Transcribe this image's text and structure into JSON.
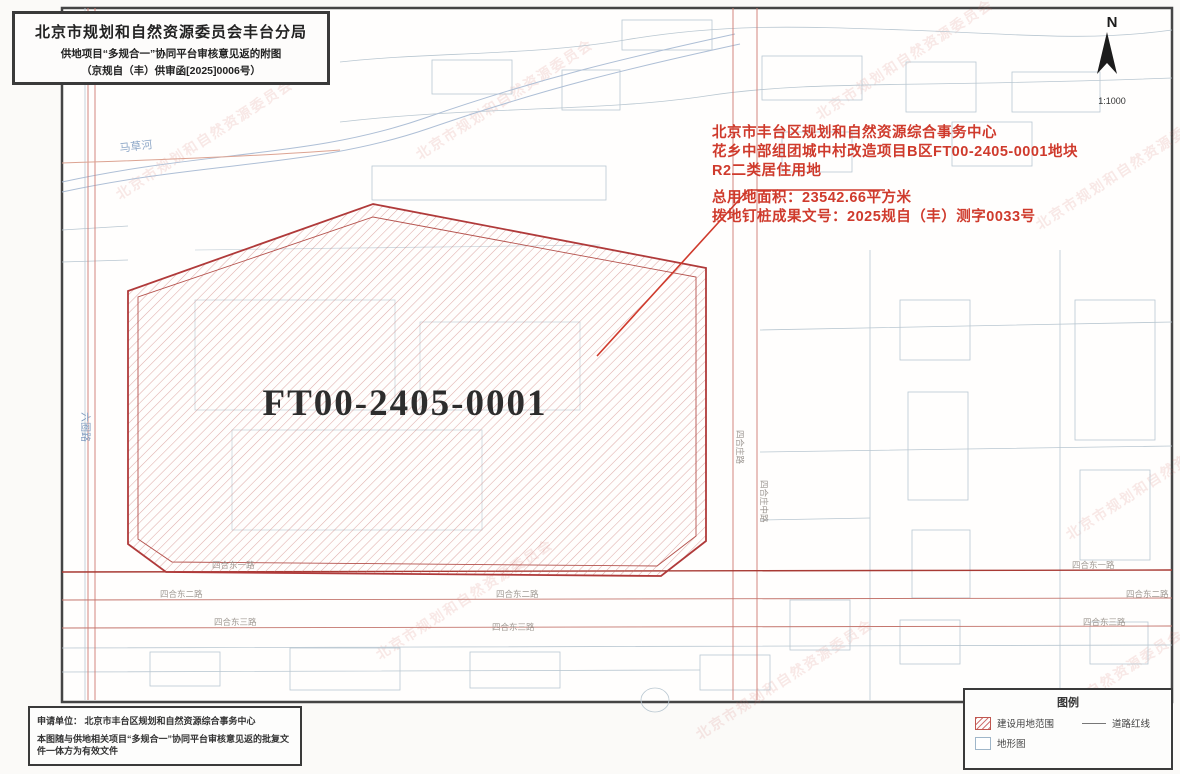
{
  "title_block": {
    "line1": "北京市规划和自然资源委员会丰台分局",
    "line2": "供地项目“多规合一”协同平台审核意见返的附图",
    "line3": "（京规自（丰）供审函[2025]0006号）"
  },
  "north": {
    "label": "N",
    "scale": "1:1000"
  },
  "annotation": {
    "line1": "北京市丰台区规划和自然资源综合事务中心",
    "line2": "花乡中部组团城中村改造项目B区FT00-2405-0001地块",
    "line3": "R2二类居住用地",
    "line4": "总用地面积：23542.66平方米",
    "line5": "拨地钉桩成果文号：2025规自（丰）测字0033号"
  },
  "parcel": {
    "label": "FT00-2405-0001"
  },
  "legend": {
    "title": "图例",
    "item_build": "建设用地范围",
    "item_road": "道路红线",
    "item_base": "地形图"
  },
  "info_block": {
    "line1": "申请单位：  北京市丰台区规划和自然资源综合事务中心",
    "line2": "本图随与供地相关项目“多规合一”协同平台审核意见返的批复文件一体方为有效文件"
  },
  "map_labels": {
    "river": "马草河",
    "road_left": "六圈路",
    "road_v1": "四合庄路",
    "road_v2": "四合庄中路",
    "road_h1": "四合东一路",
    "road_h2": "四合东二路",
    "road_h3": "四合东三路"
  },
  "watermark": {
    "text": "北京市规划和自然资源委员会"
  },
  "colors": {
    "parcel_red": "#b03a3a",
    "annotation_red": "#cf3a2c",
    "linework": "#b9c7d1",
    "frame": "#3a3a3a"
  }
}
